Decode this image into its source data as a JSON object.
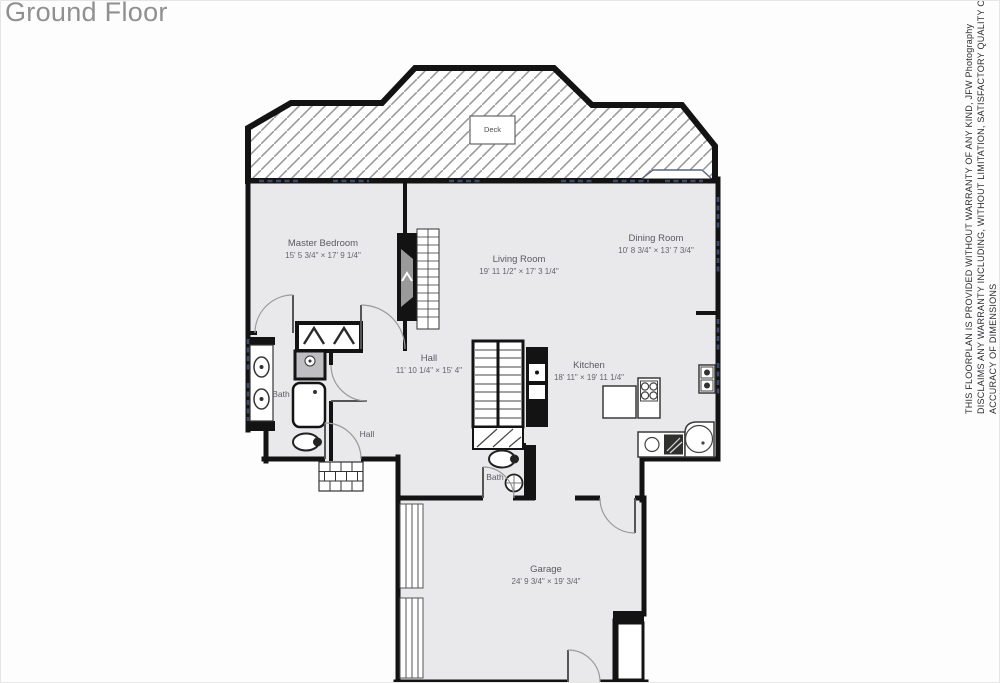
{
  "page": {
    "title": "Ground Floor"
  },
  "rooms": {
    "deck": {
      "name": "Deck"
    },
    "master_bedroom": {
      "name": "Master Bedroom",
      "dims": "15' 5 3/4\" × 17' 9 1/4\""
    },
    "living_room": {
      "name": "Living Room",
      "dims": "19' 11 1/2\" × 17' 3 1/4\""
    },
    "dining_room": {
      "name": "Dining Room",
      "dims": "10' 8 3/4\" × 13' 7 3/4\""
    },
    "hall": {
      "name": "Hall",
      "dims": "11' 10 1/4\" × 15' 4\""
    },
    "kitchen": {
      "name": "Kitchen",
      "dims": "18' 11\" × 19' 11 1/4\""
    },
    "garage": {
      "name": "Garage",
      "dims": "24' 9 3/4\" × 19' 3/4\""
    },
    "bath": {
      "name": "Bath"
    },
    "hall_small": {
      "name": "Hall"
    },
    "bath_small": {
      "name": "Bath"
    }
  },
  "disclaimer": {
    "line1": "THIS FLOORPLAN IS PROVIDED WITHOUT WARRANTY OF ANY KIND, JFW Photography",
    "line2": "DISCLAIMS ANY WARRANTY INCLUDING, WITHOUT LIMITATION, SATISFACTORY QUALITY OR",
    "line3": "ACCURACY OF DIMENSIONS"
  },
  "colors": {
    "wall": "#131313",
    "room_fill": "#e9e9ec",
    "deck_hatch": "#9a9a9a",
    "window": "#3e4a6b",
    "title_text": "#909090",
    "label_text": "#5a5a61"
  }
}
